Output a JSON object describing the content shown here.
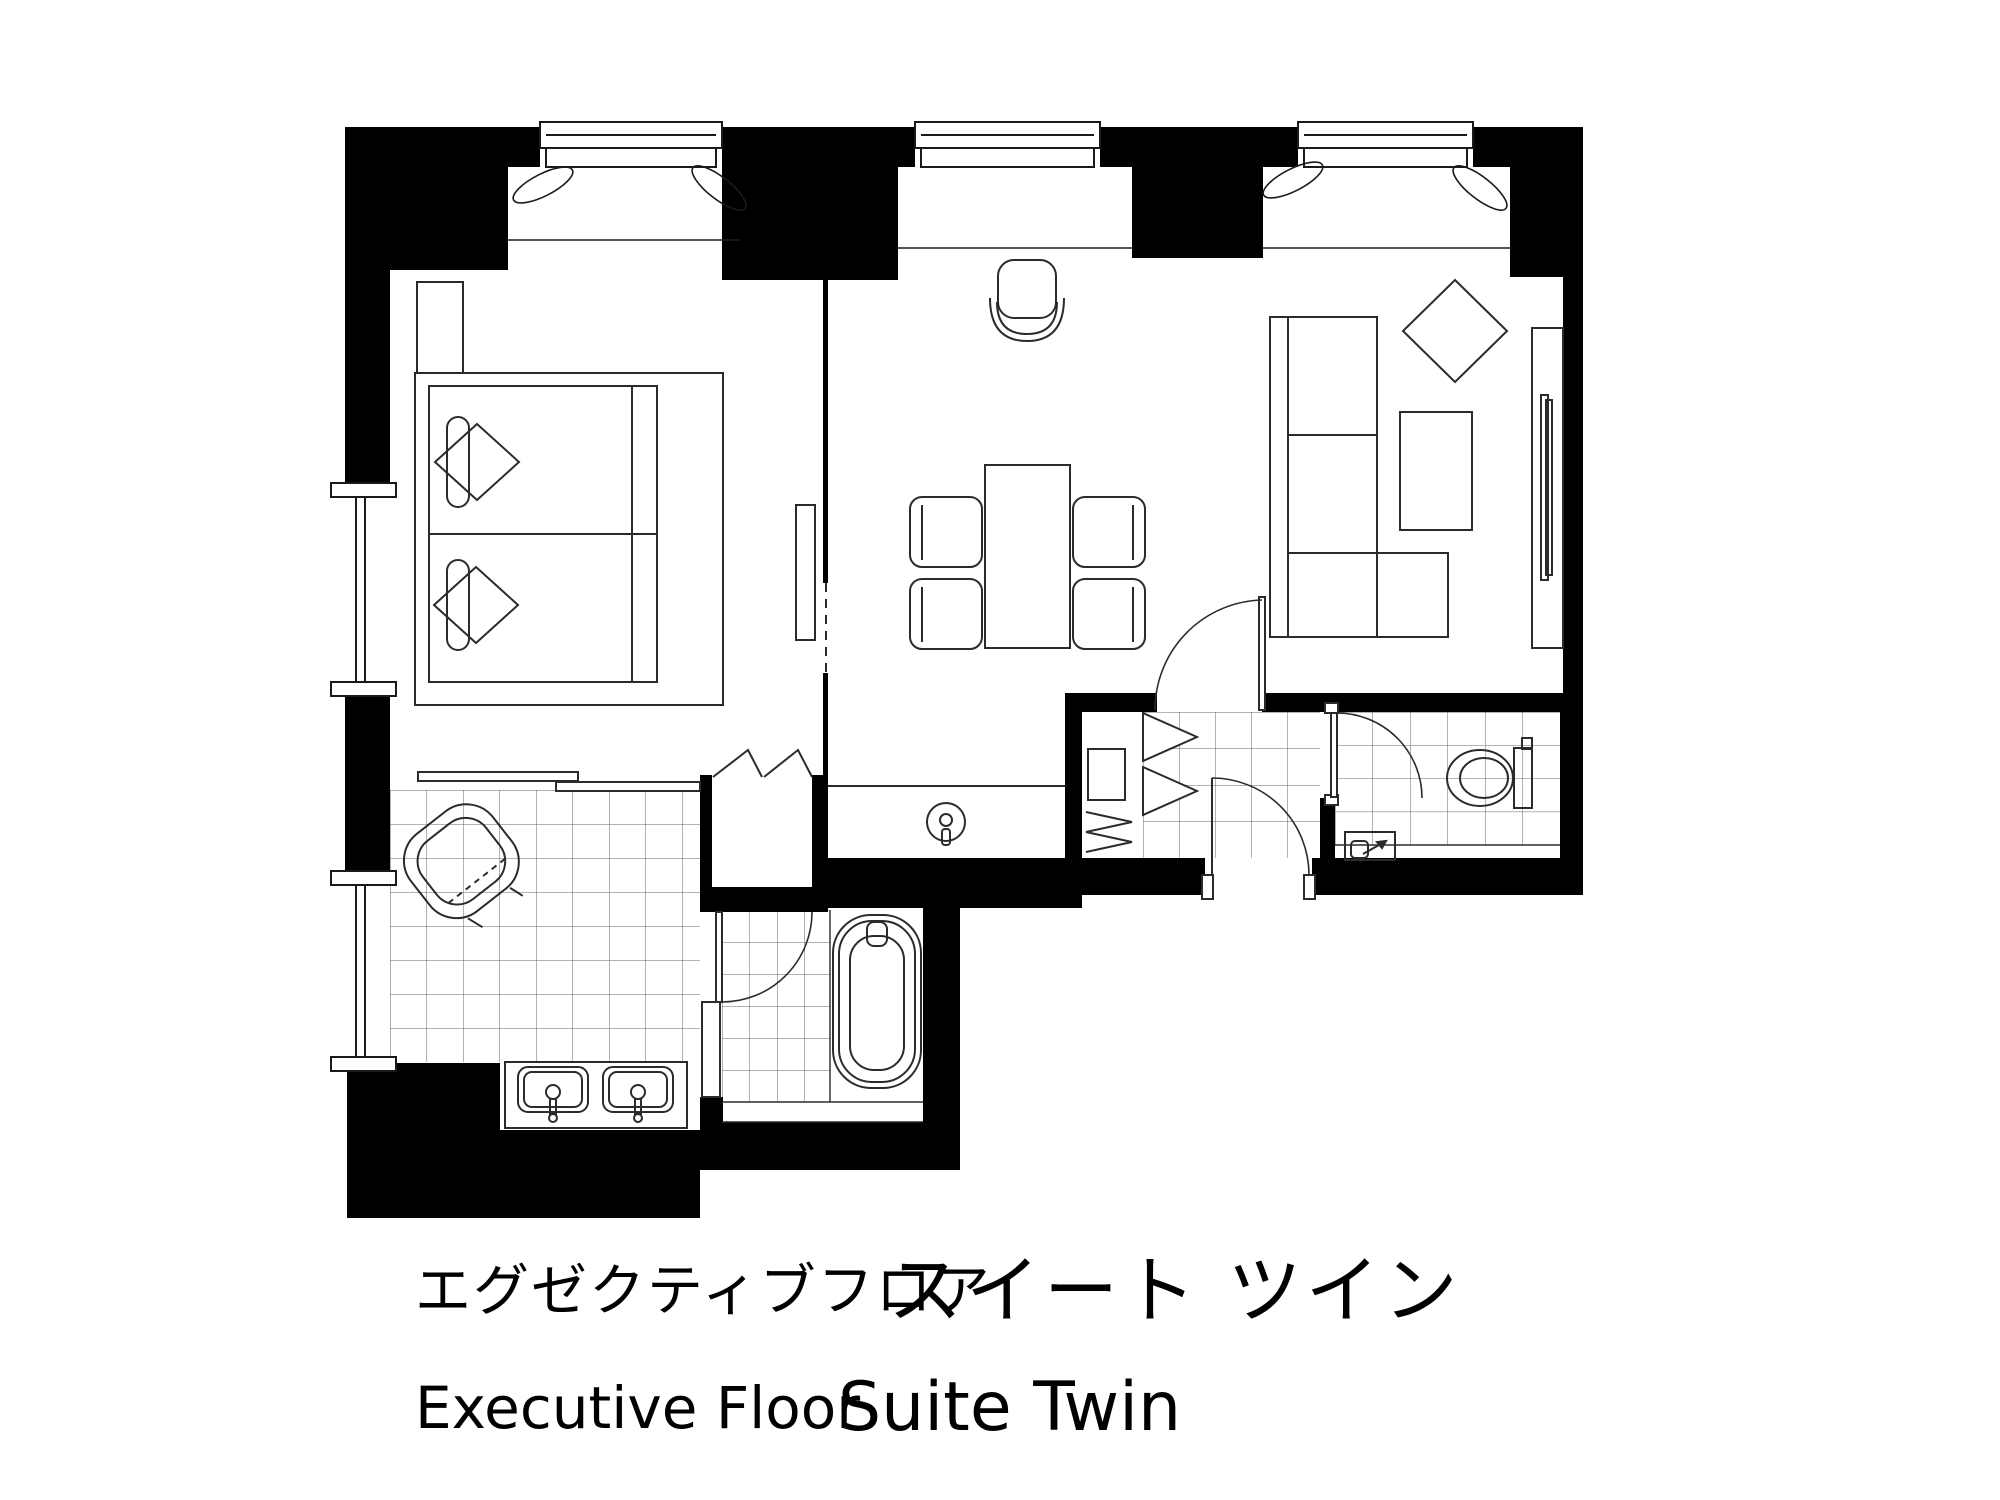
{
  "title": {
    "jp": {
      "floor": "エグゼクティブフロア",
      "room": "スイート ツイン"
    },
    "en": {
      "floor": "Executive Floor",
      "room": "Suite Twin"
    }
  },
  "colors": {
    "wall": "#000000",
    "furniture": "#2b2b2b",
    "tile": "#666666",
    "background": "#ffffff"
  },
  "rooms": [
    {
      "name": "bedroom"
    },
    {
      "name": "living-dining"
    },
    {
      "name": "powder-room"
    },
    {
      "name": "bathroom"
    },
    {
      "name": "entry-hall"
    },
    {
      "name": "toilet-room"
    }
  ],
  "fixtures": [
    "twin-bed",
    "pillows",
    "bolsters",
    "nightstand",
    "tv-console",
    "sliding-door",
    "bedroom-closet-bifold",
    "dining-table",
    "dining-chairs",
    "desk-chair",
    "sectional-sofa",
    "coffee-table",
    "decor-cushion",
    "tv-board",
    "wet-bar-sink",
    "vanity-chair",
    "double-sink-counter",
    "bathtub",
    "shower-area",
    "entry-closet",
    "hangers",
    "toilet",
    "hand-basin",
    "hinged-doors",
    "windows",
    "curtains"
  ]
}
